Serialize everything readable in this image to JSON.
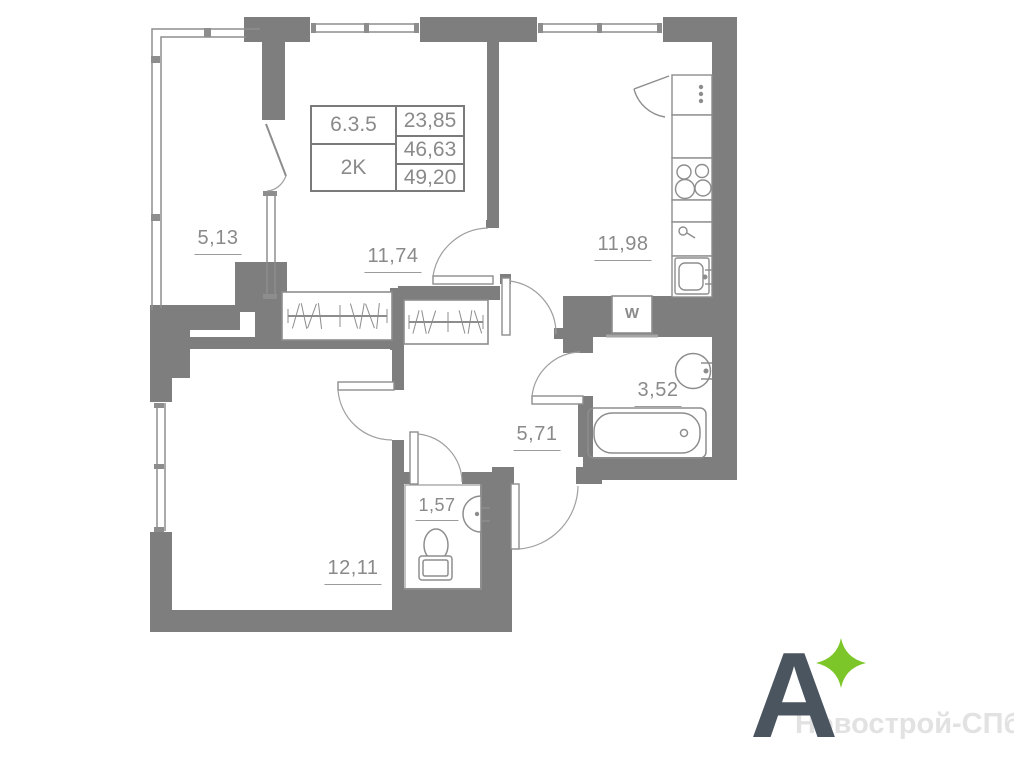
{
  "plan": {
    "info_box": {
      "unit_number": "6.3.5",
      "unit_type": "2K",
      "value_top": "23,85",
      "value_middle": "46,63",
      "value_bottom": "49,20"
    },
    "rooms": [
      {
        "name": "balcony",
        "area": "5,13"
      },
      {
        "name": "living-room",
        "area": "11,74"
      },
      {
        "name": "kitchen",
        "area": "11,98"
      },
      {
        "name": "bathroom",
        "area": "3,52"
      },
      {
        "name": "hallway",
        "area": "5,71"
      },
      {
        "name": "wc",
        "area": "1,57"
      },
      {
        "name": "bedroom",
        "area": "12,11"
      }
    ],
    "fixtures": {
      "washer_label": "W"
    },
    "colors": {
      "wall": "#7e7e7e",
      "label": "#8a8a8a"
    }
  },
  "branding": {
    "logo_letter": "A",
    "logo_color": "#4b5560",
    "star_color": "#7cc62a",
    "watermark": "Новострой-СПб",
    "watermark_color": "#e2e2e2"
  }
}
